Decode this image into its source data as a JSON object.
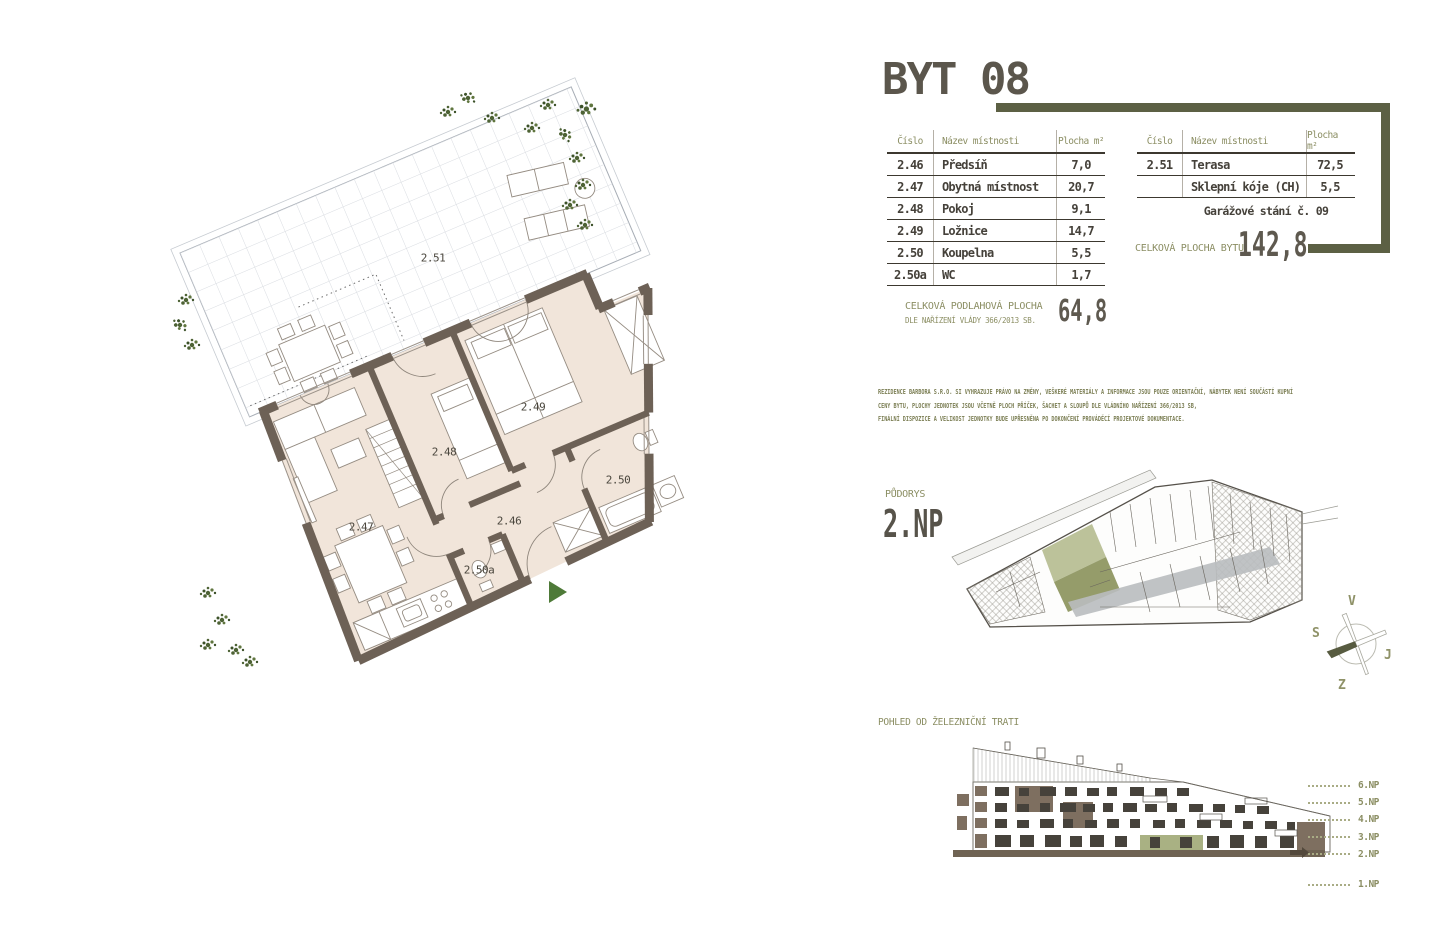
{
  "title": "BYT 08",
  "tables": {
    "left": {
      "headers": [
        "Číslo",
        "Název místnosti",
        "Plocha m²"
      ],
      "rows": [
        {
          "number": "2.46",
          "name": "Předsíň",
          "area": "7,0"
        },
        {
          "number": "2.47",
          "name": "Obytná místnost",
          "area": "20,7"
        },
        {
          "number": "2.48",
          "name": "Pokoj",
          "area": "9,1"
        },
        {
          "number": "2.49",
          "name": "Ložnice",
          "area": "14,7"
        },
        {
          "number": "2.50",
          "name": "Koupelna",
          "area": "5,5"
        },
        {
          "number": "2.50a",
          "name": "WC",
          "area": "1,7"
        }
      ]
    },
    "right": {
      "headers": [
        "Číslo",
        "Název místnosti",
        "Plocha m²"
      ],
      "rows": [
        {
          "number": "2.51",
          "name": "Terasa",
          "area": "72,5"
        },
        {
          "number": "",
          "name": "Sklepní kóje (CH)",
          "area": "5,5"
        }
      ],
      "note": "Garážové stání č. 09"
    }
  },
  "totals": {
    "total_area_label": "CELKOVÁ PLOCHA BYTU",
    "total_area_value": "142,8",
    "floor_area_label": "CELKOVÁ PODLAHOVÁ PLOCHA",
    "floor_area_sublabel": "DLE NAŘÍZENÍ VLÁDY 366/2013 SB.",
    "floor_area_value": "64,8"
  },
  "disclaimer": [
    "REZIDENCE BARBORA S.R.O. SI VYHRAZUJE PRÁVO NA ZMĚNY, VEŠKERÉ MATERIÁLY A INFORMACE JSOU POUZE ORIENTAČNÍ, NÁBYTEK NENÍ SOUČÁSTÍ KUPNÍ",
    "CENY BYTU, PLOCHY JEDNOTEK JSOU VČETNĚ PLOCH PŘÍČEK, ŠACHET A SLOUPŮ DLE VLÁDNÍHO NAŘÍZENÍ 366/2013 SB,",
    "FINÁLNÍ DISPOZICE A VELIKOST JEDNOTKY BUDE UPŘESNĚNA PO DOKONČENÍ PROVÁDĚCÍ PROJEKTOVÉ DOKUMENTACE."
  ],
  "site_plan": {
    "caption": "PŮDORYS",
    "floor": "2.NP"
  },
  "compass": {
    "top": "V",
    "left": "S",
    "right": "J",
    "bottom": "Z"
  },
  "elevation": {
    "caption": "POHLED OD ŽELEZNIČNÍ TRATI",
    "floors": [
      "6.NP",
      "5.NP",
      "4.NP",
      "3.NP",
      "2.NP",
      "1.NP"
    ],
    "highlighted_floor": "2.NP"
  },
  "floorplan": {
    "rooms": [
      {
        "id": "2.51"
      },
      {
        "id": "2.49"
      },
      {
        "id": "2.48"
      },
      {
        "id": "2.50"
      },
      {
        "id": "2.47"
      },
      {
        "id": "2.46"
      },
      {
        "id": "2.50a"
      }
    ]
  },
  "colors": {
    "accent_olive": "#5c6044",
    "olive_text": "#8b8e63",
    "dark_text": "#5b564c",
    "wall_brown": "#6d6156",
    "floor_fill": "#f1e5da",
    "unit_highlight": "#959c6a",
    "entrance_green": "#4e7a38"
  }
}
